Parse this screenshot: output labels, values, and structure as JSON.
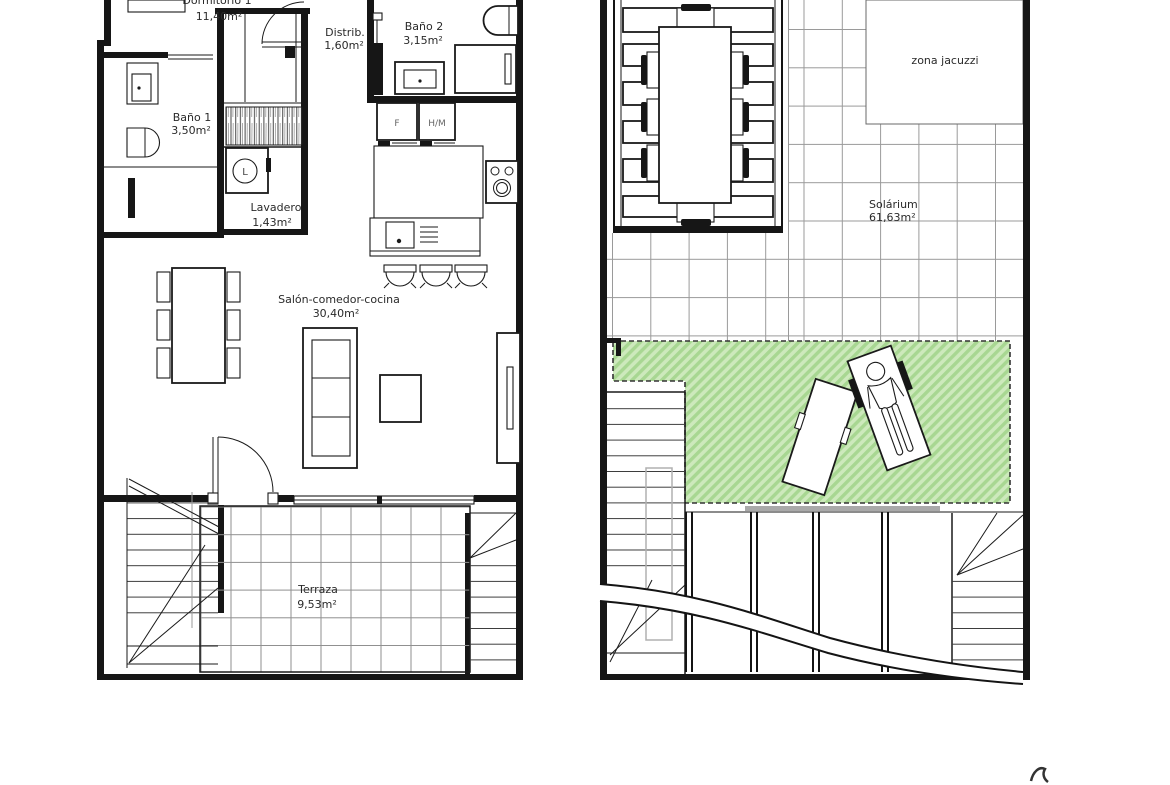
{
  "ground_floor": {
    "dormitorio1_name": "Dormitorio 1",
    "dormitorio1_area": "11,40m²",
    "distribuidor_name": "Distrib.",
    "distribuidor_area": "1,60m²",
    "bano2_name": "Baño 2",
    "bano2_area": "3,15m²",
    "bano1_name": "Baño 1",
    "bano1_area": "3,50m²",
    "lavadero_name": "Lavadero",
    "lavadero_area": "1,43m²",
    "salon_name": "Salón-comedor-cocina",
    "salon_area": "30,40m²",
    "terraza_name": "Terraza",
    "terraza_area": "9,53m²",
    "fridge_label": "F",
    "oven_micro_label": "H/M",
    "washer_label": "L"
  },
  "solarium_floor": {
    "jacuzzi_label": "zona jacuzzi",
    "solarium_name": "Solárium",
    "solarium_area": "61,63m²"
  },
  "colors": {
    "line": "#1a1a1a",
    "grid_gray": "#9a9a9a",
    "hatch_green_light": "#cde9bc",
    "hatch_green_dark": "#a8d792"
  }
}
